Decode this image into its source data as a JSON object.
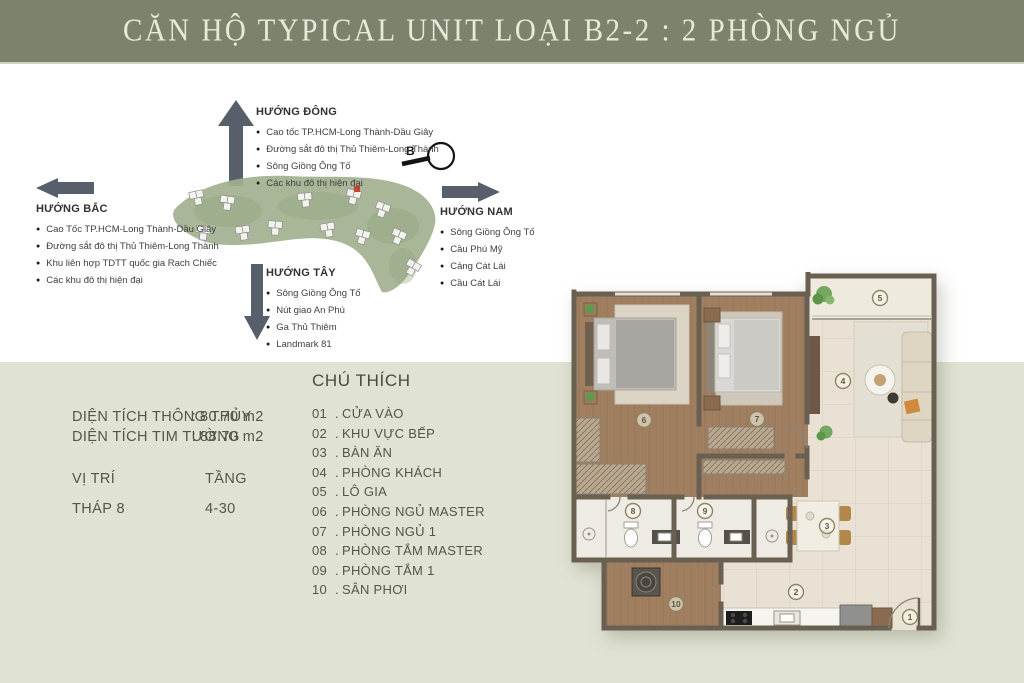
{
  "title": {
    "text": "CĂN HỘ TYPICAL UNIT LOẠI  B2-2 : 2 PHÒNG NGỦ"
  },
  "bullet": "●",
  "compass": {
    "label": "B"
  },
  "directions": {
    "dong": {
      "label": "HƯỚNG ĐÔNG",
      "items": [
        "Cao tốc TP.HCM-Long Thành-Dầu Giây",
        "Đường sắt đô thị Thủ Thiêm-Long Thành",
        "Sông Giồng Ông Tố",
        "Các khu đô thị hiện đại"
      ]
    },
    "bac": {
      "label": "HƯỚNG BẮC",
      "items": [
        "Cao Tốc TP.HCM-Long Thành-Dầu Giây",
        "Đường sắt đô thị Thủ Thiêm-Long Thành",
        "Khu liên hợp TDTT quốc gia Rạch Chiếc",
        "Các khu đô thị hiện đại"
      ]
    },
    "nam": {
      "label": "HƯỚNG NAM",
      "items": [
        "Sông Giồng Ông Tố",
        "Cầu Phú Mỹ",
        "Cảng Cát Lái",
        "Cầu Cát Lái"
      ]
    },
    "tay": {
      "label": "HƯỚNG TÂY",
      "items": [
        "Sông Giồng Ông Tố",
        "Nút giao An Phú",
        "Ga Thủ Thiêm",
        "Landmark 81"
      ]
    }
  },
  "info": {
    "sep": ":",
    "area_rows": [
      {
        "label": "DIỆN TÍCH THÔNG THỦY",
        "value": "80.70 m2"
      },
      {
        "label": "DIỆN TÍCH TIM TƯỜNG",
        "value": "88.70 m2"
      }
    ],
    "position_label": "VỊ TRÍ",
    "floor_label": "TẦNG",
    "position_value": "THÁP 8",
    "floor_value": "4-30"
  },
  "legend": {
    "title": "CHÚ THÍCH",
    "sep": ".",
    "items": [
      {
        "num": "01",
        "label": "CỬA VÀO"
      },
      {
        "num": "02",
        "label": "KHU VỰC BẾP"
      },
      {
        "num": "03",
        "label": "BÀN ĂN"
      },
      {
        "num": "04",
        "label": "PHÒNG KHÁCH"
      },
      {
        "num": "05",
        "label": "LÔ GIA"
      },
      {
        "num": "06",
        "label": "PHÒNG NGỦ MASTER"
      },
      {
        "num": "07",
        "label": "PHÒNG NGỦ 1"
      },
      {
        "num": "08",
        "label": "PHÒNG TẮM MASTER"
      },
      {
        "num": "09",
        "label": "PHÒNG TẮM 1"
      },
      {
        "num": "10",
        "label": "SÂN PHƠI"
      }
    ]
  },
  "floorplan": {
    "markers": [
      "1",
      "2",
      "3",
      "4",
      "5",
      "6",
      "7",
      "8",
      "9",
      "10"
    ]
  },
  "colors": {
    "title_bar": "#7c836c",
    "band": "#e0e3d3",
    "arrow": "#57606a",
    "sitemap_green": "#a3b08f",
    "highlight_red": "#c44536",
    "wood_floor": "#a07f61",
    "tile_floor": "#e9e2d4",
    "wall": "#696052"
  }
}
